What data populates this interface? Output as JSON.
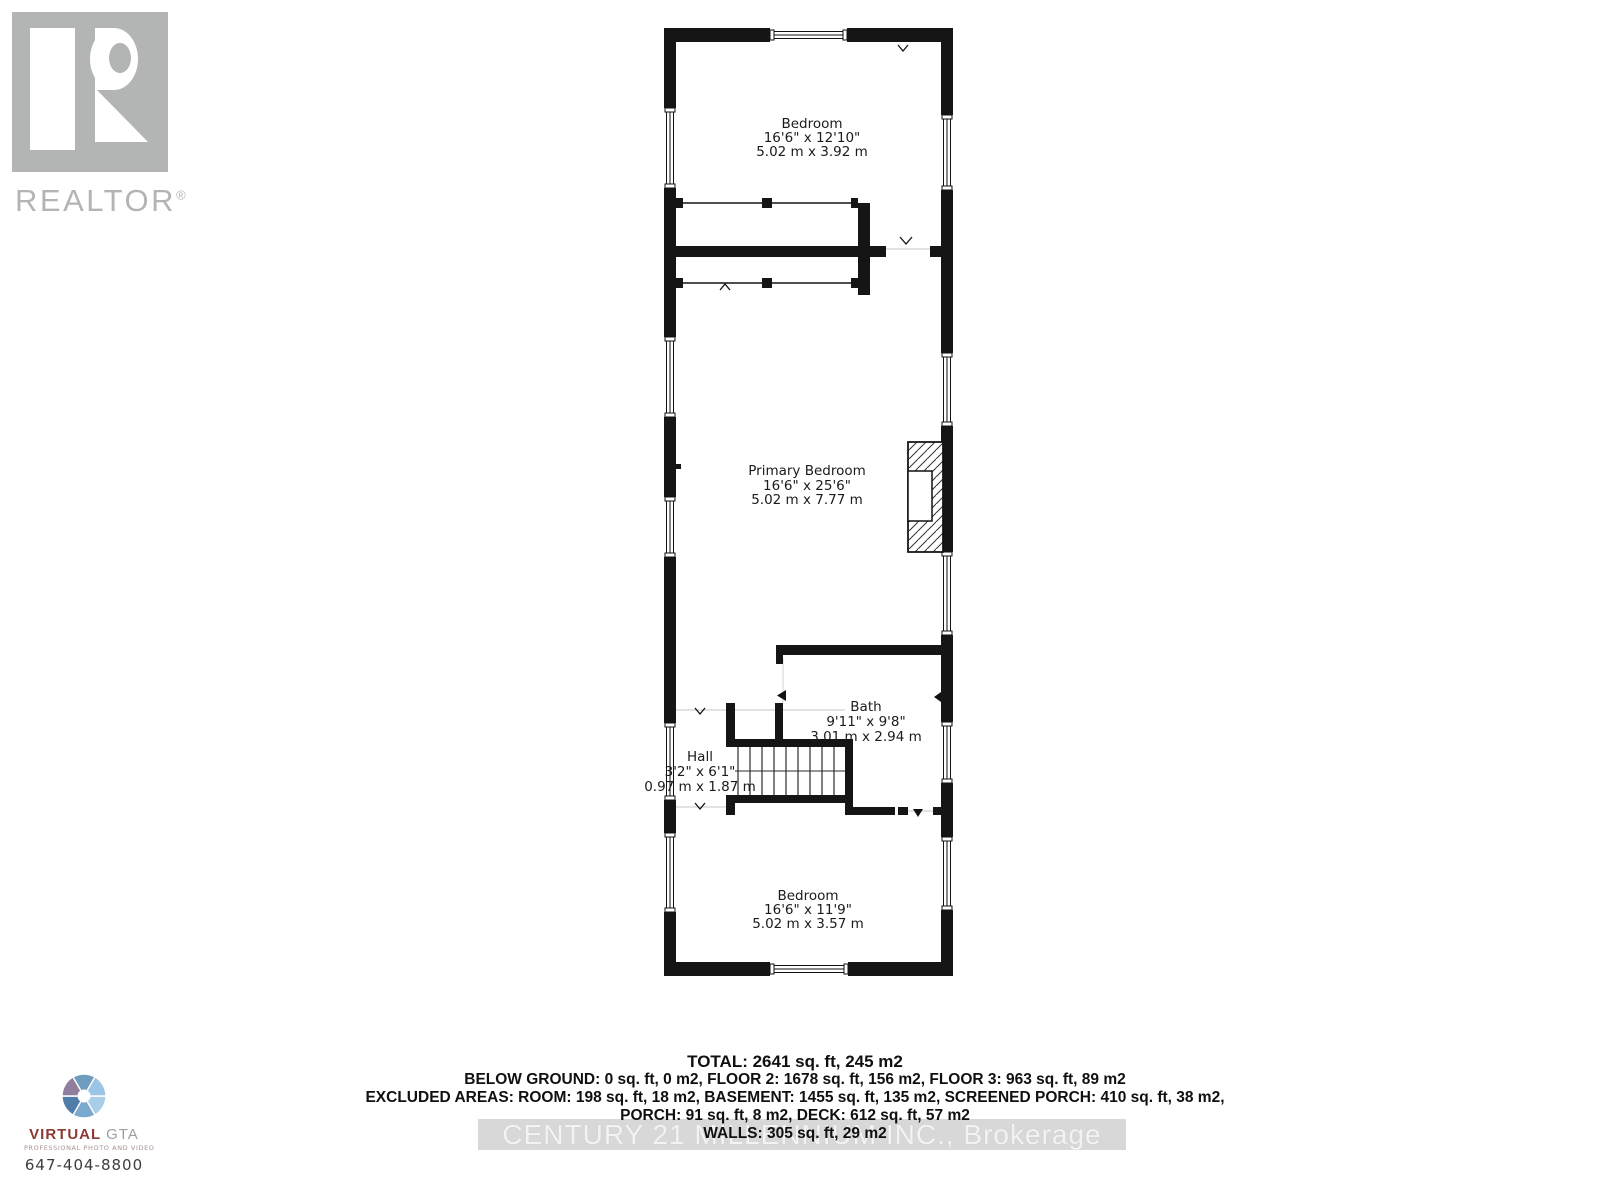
{
  "branding": {
    "logo_text": "REALTOR",
    "registered": "®"
  },
  "floor_plan": {
    "rooms": [
      {
        "name": "Bedroom",
        "imperial": "16'6\" x 12'10\"",
        "metric": "5.02 m x 3.92 m"
      },
      {
        "name": "Primary Bedroom",
        "imperial": "16'6\" x 25'6\"",
        "metric": "5.02 m x 7.77 m"
      },
      {
        "name": "Bath",
        "imperial": "9'11\" x 9'8\"",
        "metric": "3.01 m x 2.94 m"
      },
      {
        "name": "Hall",
        "imperial": "3'2\" x 6'1\"",
        "metric": "0.97 m x 1.87 m"
      },
      {
        "name": "Bedroom",
        "imperial": "16'6\" x 11'9\"",
        "metric": "5.02 m x 3.57 m"
      }
    ]
  },
  "summary": {
    "total": "TOTAL: 2641 sq. ft, 245 m2",
    "floors": "BELOW GROUND: 0 sq. ft, 0 m2, FLOOR 2: 1678 sq. ft, 156 m2, FLOOR 3: 963 sq. ft, 89 m2",
    "excluded": "EXCLUDED AREAS: ROOM: 198 sq. ft, 18 m2, BASEMENT: 1455 sq. ft, 135 m2, SCREENED PORCH: 410 sq. ft, 38 m2,",
    "porch_deck": "PORCH: 91 sq. ft, 8 m2, DECK: 612 sq. ft, 57 m2",
    "walls": "WALLS: 305 sq. ft, 29 m2"
  },
  "watermark": {
    "text": "CENTURY 21 MILLENNIUM INC., Brokerage"
  },
  "photographer": {
    "brand_primary": "VIRTUAL",
    "brand_secondary": "GTA",
    "tagline": "PROFESSIONAL PHOTO AND VIDEO",
    "phone": "647-404-8800"
  },
  "colors": {
    "wall": "#151515",
    "logo_gray": "#b3b5b5",
    "brand_red": "#8c3a33",
    "watermark_band": "#d8d8d8",
    "aperture_blue": "#6f9dc0",
    "aperture_blue_light": "#9cc4e4",
    "aperture_purple": "#8f7e9e"
  }
}
